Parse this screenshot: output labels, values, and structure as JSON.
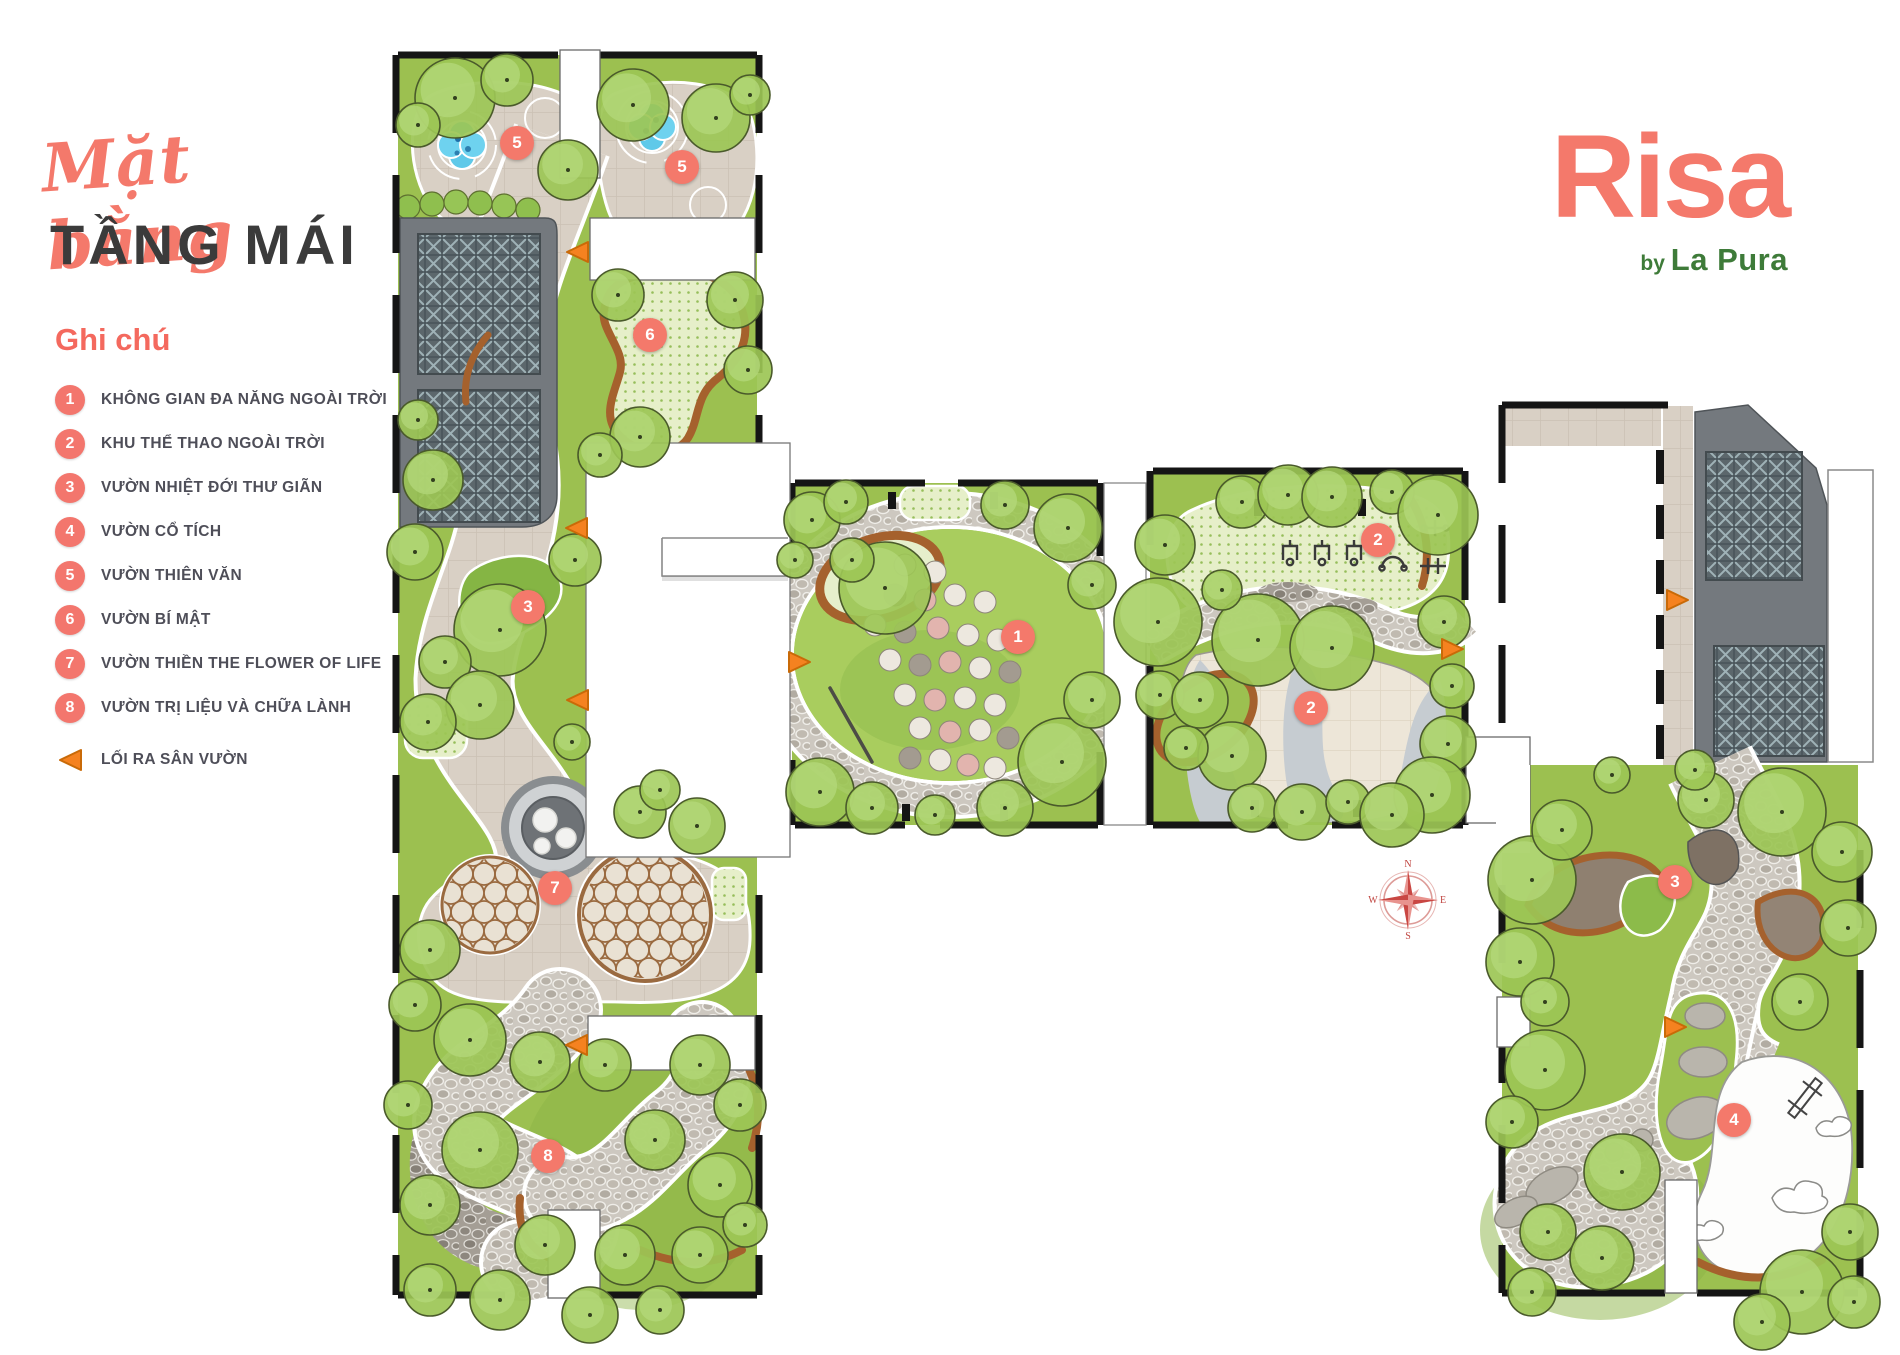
{
  "title": {
    "script": "Mặt bằng",
    "main": "TẦNG MÁI"
  },
  "legend": {
    "heading": "Ghi chú",
    "items": [
      {
        "n": "1",
        "label": "KHÔNG GIAN ĐA NĂNG NGOÀI TRỜI"
      },
      {
        "n": "2",
        "label": "KHU THỂ THAO NGOÀI TRỜI"
      },
      {
        "n": "3",
        "label": "VƯỜN NHIỆT ĐỚI THƯ GIÃN"
      },
      {
        "n": "4",
        "label": "VƯỜN CỔ TÍCH"
      },
      {
        "n": "5",
        "label": "VƯỜN THIÊN VĂN"
      },
      {
        "n": "6",
        "label": "VƯỜN BÍ MẬT"
      },
      {
        "n": "7",
        "label": "VƯỜN THIỀN THE FLOWER OF LIFE"
      },
      {
        "n": "8",
        "label": "VƯỜN TRỊ LIỆU VÀ CHỮA LÀNH"
      }
    ],
    "exit_label": "LỐI RA SÂN VƯỜN"
  },
  "logo": {
    "name": "Risa",
    "byline_prefix": "by",
    "byline": "La Pura"
  },
  "colors": {
    "accent_coral": "#F4796B",
    "legend_text": "#4E4E58",
    "title_dark": "#3B3B3B",
    "logo_green": "#3E7B39",
    "exit_orange": "#F58220",
    "lawn_green": "#9CC050",
    "path_beige": "#D9D0C5",
    "deck_gray": "#74797E",
    "water_blue": "#5FC9E9",
    "bench_brown": "#A5612D",
    "compass_red": "#C94743"
  },
  "plan": {
    "markers": [
      {
        "n": "5",
        "x": 517,
        "y": 143
      },
      {
        "n": "5",
        "x": 682,
        "y": 167
      },
      {
        "n": "6",
        "x": 650,
        "y": 335
      },
      {
        "n": "3",
        "x": 528,
        "y": 607
      },
      {
        "n": "7",
        "x": 555,
        "y": 888
      },
      {
        "n": "8",
        "x": 548,
        "y": 1156
      },
      {
        "n": "1",
        "x": 1018,
        "y": 637
      },
      {
        "n": "2",
        "x": 1378,
        "y": 540
      },
      {
        "n": "2",
        "x": 1311,
        "y": 708
      },
      {
        "n": "3",
        "x": 1675,
        "y": 882
      },
      {
        "n": "4",
        "x": 1734,
        "y": 1120
      }
    ],
    "exits": [
      {
        "x": 577,
        "y": 252,
        "dir": "left"
      },
      {
        "x": 576,
        "y": 528,
        "dir": "left"
      },
      {
        "x": 577,
        "y": 700,
        "dir": "left"
      },
      {
        "x": 576,
        "y": 1045,
        "dir": "left"
      },
      {
        "x": 800,
        "y": 662,
        "dir": "right"
      },
      {
        "x": 1453,
        "y": 649,
        "dir": "right"
      },
      {
        "x": 1678,
        "y": 600,
        "dir": "right"
      },
      {
        "x": 1676,
        "y": 1027,
        "dir": "right"
      }
    ],
    "compass": {
      "x": 1408,
      "y": 900,
      "letters": [
        "N",
        "E",
        "S",
        "W"
      ]
    }
  }
}
